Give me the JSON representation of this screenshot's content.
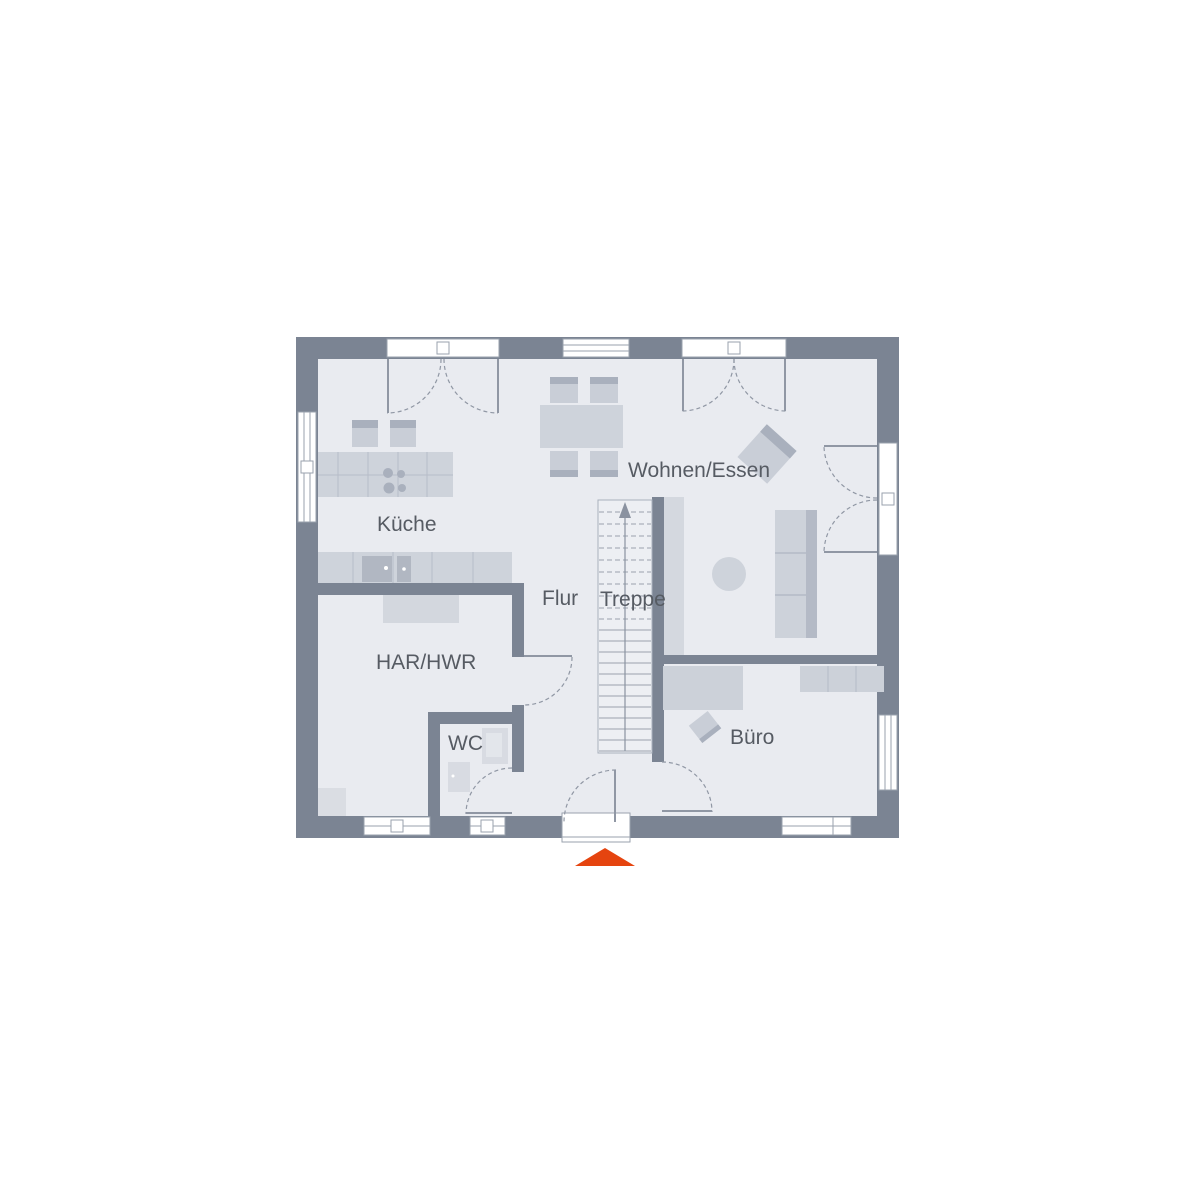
{
  "plan": {
    "rooms": {
      "kitchen": "Küche",
      "living_dining": "Wohnen/Essen",
      "hall": "Flur",
      "stairs": "Treppe",
      "utility": "HAR/HWR",
      "wc": "WC",
      "office": "Büro"
    },
    "colors": {
      "wall": "#7b8493",
      "floor": "#e9ebf0",
      "furniture": "#ced3db",
      "furniture_dark": "#a9b0bd",
      "line": "#9aa2ae",
      "text": "#565b63",
      "accent": "#e5440f"
    },
    "icons": {
      "entrance_marker": "entrance-triangle-icon",
      "stair_direction": "up-arrow-icon"
    }
  }
}
